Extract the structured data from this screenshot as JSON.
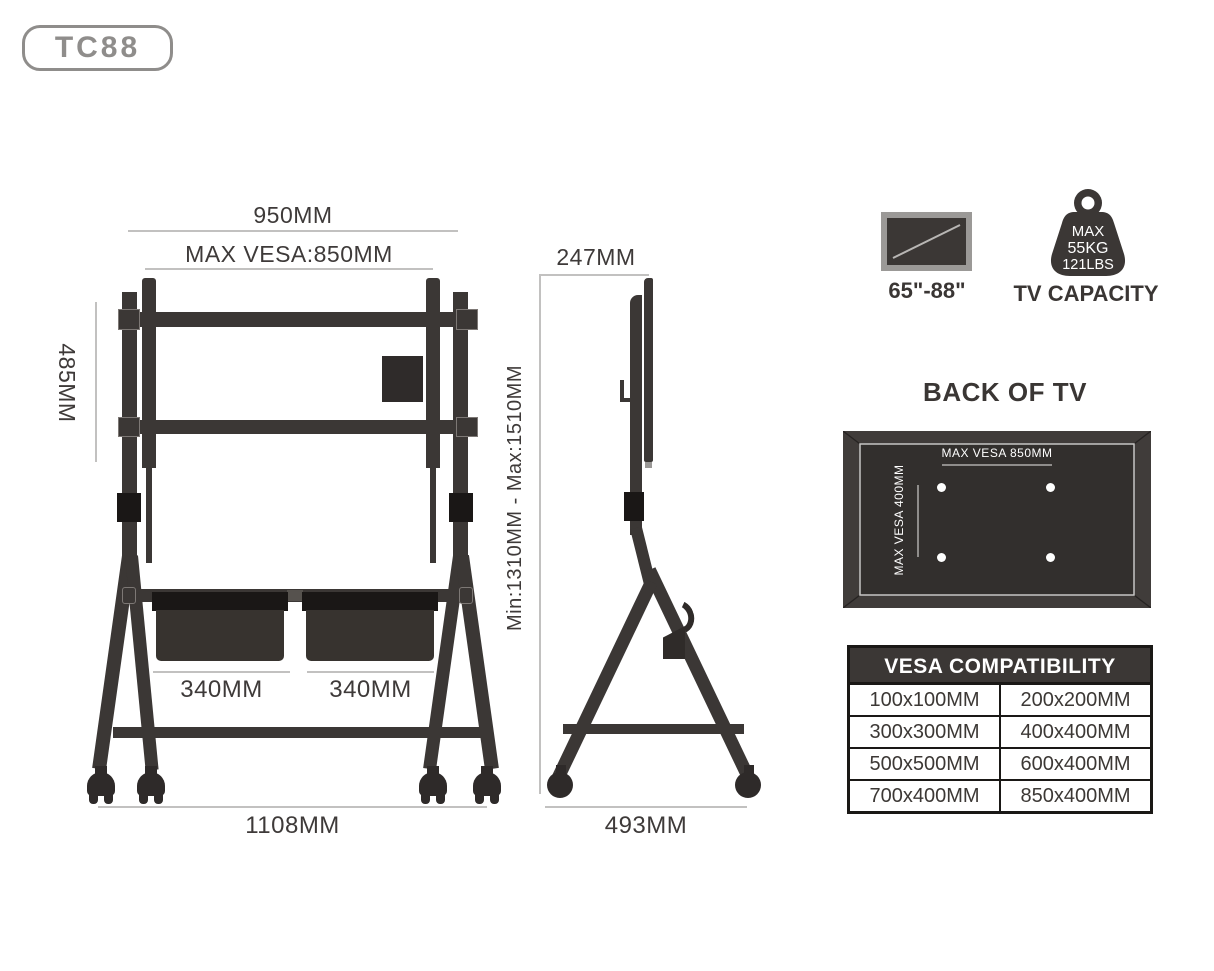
{
  "badge": {
    "label": "TC88"
  },
  "front_view": {
    "dim_width_top": "950MM",
    "dim_max_vesa": "MAX VESA:850MM",
    "dim_bracket_height": "485MM",
    "dim_box_left": "340MM",
    "dim_box_right": "340MM",
    "dim_total_width": "1108MM"
  },
  "side_view": {
    "dim_depth_top": "247MM",
    "dim_height_range": "Min:1310MM - Max:1510MM",
    "dim_base_depth": "493MM"
  },
  "icons": {
    "tv_size_label": "65\"-88\"",
    "capacity_line1": "MAX",
    "capacity_line2": "55KG",
    "capacity_line3": "121LBS",
    "capacity_label": "TV CAPACITY"
  },
  "back_of_tv": {
    "title": "BACK OF TV",
    "max_vesa_horizontal": "MAX VESA 850MM",
    "max_vesa_vertical": "MAX VESA 400MM"
  },
  "vesa_table": {
    "title": "VESA COMPATIBILITY",
    "rows": [
      [
        "100x100MM",
        "200x200MM"
      ],
      [
        "300x300MM",
        "400x400MM"
      ],
      [
        "500x500MM",
        "600x400MM"
      ],
      [
        "700x400MM",
        "850x400MM"
      ]
    ]
  },
  "colors": {
    "structure": "#3b3735",
    "accent_black": "#1a1716",
    "dim_text": "#3e3a39",
    "dim_line": "#c2c1c0",
    "badge_gray": "#8f8d8b",
    "tv_frame_gray": "#9b9997",
    "panel_frame": "#403c3a",
    "panel_inner": "#322f2d",
    "panel_line": "#8f8d8b",
    "white": "#ffffff",
    "table_border": "#1a1816"
  }
}
